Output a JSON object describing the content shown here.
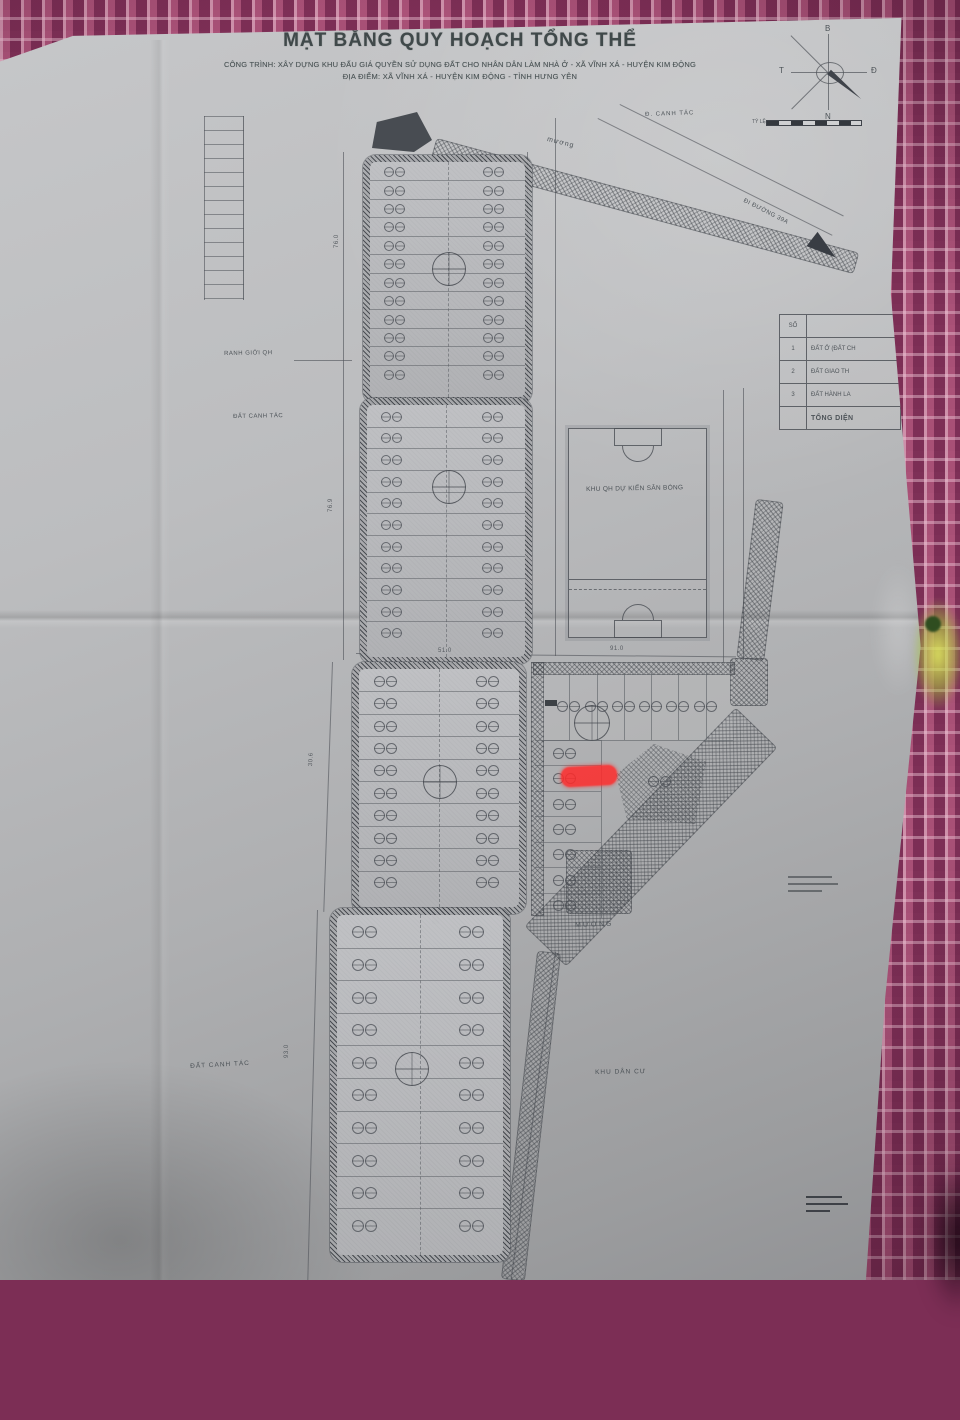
{
  "photo": {
    "fabric_color": "#8a3a63",
    "paper_color": "#b6b7b9",
    "ink_color": "#4c5056",
    "highlight_color": "#ff2b2b"
  },
  "title_block": {
    "title": "MẶT BẰNG QUY HOẠCH TỔNG THỂ",
    "project_line": "CÔNG TRÌNH: XÂY DỰNG KHU ĐẤU GIÁ QUYỀN SỬ DỤNG ĐẤT CHO NHÂN DÂN LÀM NHÀ Ở - XÃ VĨNH XÁ - HUYỆN KIM ĐỘNG",
    "location_line": "ĐỊA ĐIỂM: XÃ VĨNH XÁ - HUYỆN KIM ĐỘNG - TỈNH HƯNG YÊN"
  },
  "compass": {
    "n": "B",
    "s": "N",
    "e": "Đ",
    "w": "T"
  },
  "scale_bar": {
    "label": "TỶ LỆ"
  },
  "legend": {
    "header": "SỐ",
    "rows": [
      {
        "num": "1",
        "label": "ĐẤT Ở (ĐẤT CH"
      },
      {
        "num": "2",
        "label": "ĐẤT GIAO TH"
      },
      {
        "num": "3",
        "label": "ĐẤT HÀNH LA"
      }
    ],
    "footer": "TỔNG DIỆN"
  },
  "map": {
    "labels": [
      {
        "id": "muong-top",
        "text": "mương",
        "x": 548,
        "y": 136,
        "rot": 14,
        "size": 7,
        "tracking": 1
      },
      {
        "id": "dat-canh-tac-top",
        "text": "Đ. CANH TÁC",
        "x": 645,
        "y": 112,
        "rot": -2,
        "size": 6,
        "tracking": 1
      },
      {
        "id": "ranh-gioi-qh",
        "text": "RANH GIỚI QH",
        "x": 224,
        "y": 351,
        "rot": -1,
        "size": 6,
        "tracking": 0.5
      },
      {
        "id": "dat-canh-tac-left",
        "text": "ĐẤT CANH TÁC",
        "x": 233,
        "y": 414,
        "rot": -1,
        "size": 6,
        "tracking": 0.5
      },
      {
        "id": "san-bong",
        "text": "KHU QH DỰ KIẾN SÂN BÓNG",
        "x": 586,
        "y": 486,
        "rot": -1,
        "size": 6.5,
        "tracking": 0.3
      },
      {
        "id": "di-duong",
        "text": "ĐI ĐƯỜNG 39A",
        "x": 745,
        "y": 198,
        "rot": 27,
        "size": 6,
        "tracking": 0.5
      },
      {
        "id": "muong-bottom",
        "text": "MƯƠNG",
        "x": 575,
        "y": 922,
        "rot": -2,
        "size": 7,
        "tracking": 2
      },
      {
        "id": "khu-dan-cu",
        "text": "KHU DÂN CƯ",
        "x": 595,
        "y": 1069,
        "rot": -1,
        "size": 6.5,
        "tracking": 1
      },
      {
        "id": "dat-canh-tac-bottom",
        "text": "ĐẤT CANH TÁC",
        "x": 190,
        "y": 1063,
        "rot": -3,
        "size": 6.5,
        "tracking": 1
      }
    ],
    "dimensions": [
      {
        "text": "76.0",
        "x": 334,
        "y": 248,
        "rot": -90
      },
      {
        "text": "76.9",
        "x": 328,
        "y": 512,
        "rot": -90
      },
      {
        "text": "30.6",
        "x": 308,
        "y": 766,
        "rot": -87
      },
      {
        "text": "93.0",
        "x": 284,
        "y": 1058,
        "rot": -90
      },
      {
        "text": "51.0",
        "x": 438,
        "y": 648,
        "rot": 0
      },
      {
        "text": "91.0",
        "x": 610,
        "y": 646,
        "rot": 0
      }
    ],
    "blocks": [
      {
        "x": 363,
        "y": 155,
        "w": 155,
        "h": 235,
        "rows": 12,
        "stamp": 8,
        "cx": 0.55,
        "cy": 0.48
      },
      {
        "x": 360,
        "y": 398,
        "w": 158,
        "h": 252,
        "rows": 11,
        "stamp": 8,
        "cx": 0.56,
        "cy": 0.34
      },
      {
        "x": 352,
        "y": 662,
        "w": 160,
        "h": 238,
        "rows": 10,
        "stamp": 9,
        "cx": 0.55,
        "cy": 0.5
      },
      {
        "x": 330,
        "y": 908,
        "w": 166,
        "h": 340,
        "rows": 10,
        "stamp": 10,
        "cx": 0.49,
        "cy": 0.47
      }
    ],
    "block_e": {
      "x": 533,
      "y": 662,
      "w": 200,
      "h": 78,
      "cols": 7,
      "left_x": 535,
      "left_y": 740,
      "left_w": 66,
      "left_h": 178,
      "left_rows": 7
    },
    "field": {
      "x": 568,
      "y": 428,
      "w": 137,
      "h": 208
    },
    "highlight": {
      "x": 561,
      "y": 766,
      "w": 56,
      "h": 20,
      "rot": -3
    }
  }
}
